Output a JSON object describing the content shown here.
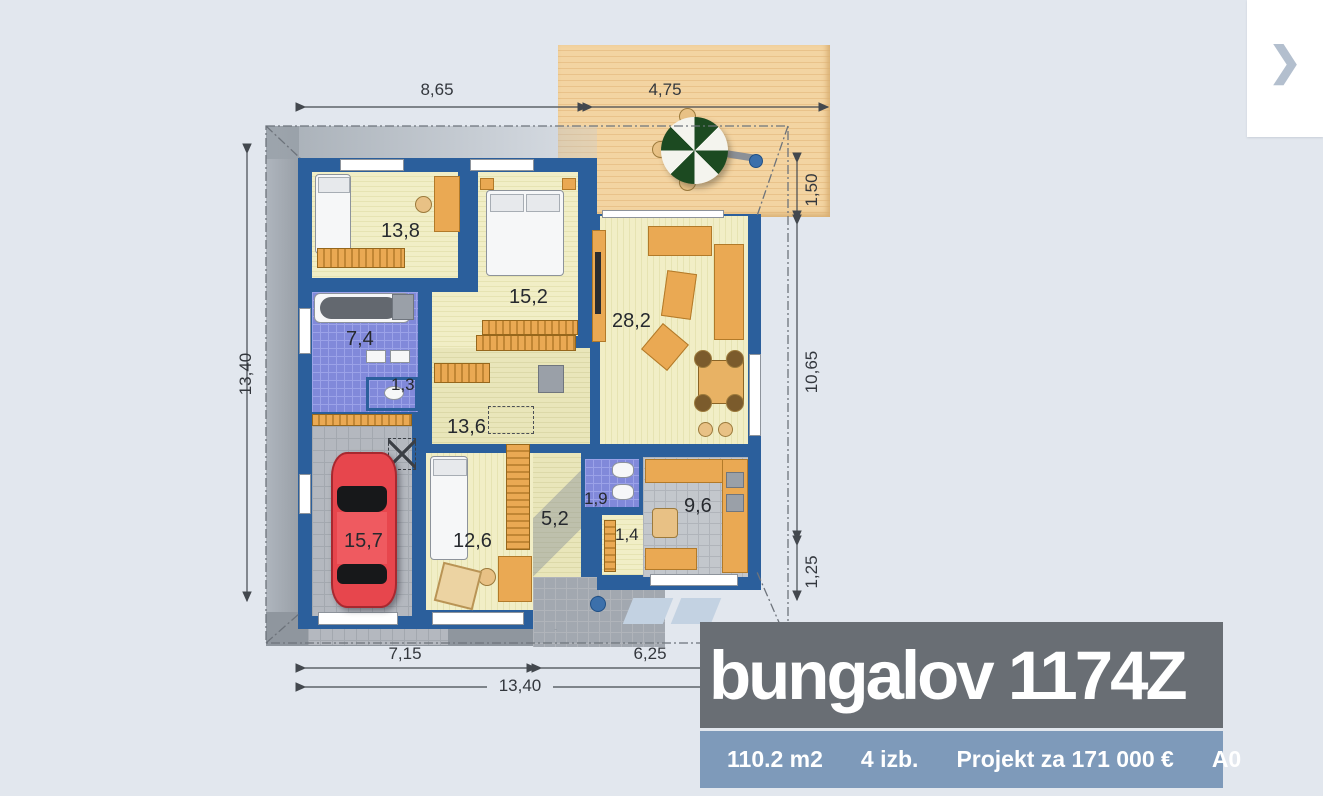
{
  "colors": {
    "page_bg": "#e2e7ee",
    "wall_blue": "#2b5f9c",
    "floor_pale": "#efecc3",
    "tile_blue": "#8189da",
    "deck_wood": "#f1ce9c",
    "car_red": "#e8424a",
    "title_bg": "#696e74",
    "stats_bg": "#7e9aba"
  },
  "gallery": {
    "next_icon": "❯"
  },
  "title_card": {
    "title": "bungalov 1174Z"
  },
  "stats_bar": {
    "items": [
      {
        "label": "110.2 m2"
      },
      {
        "label": "4 izb."
      },
      {
        "label": "Projekt za 171 000 €"
      },
      {
        "label": "A0"
      }
    ]
  },
  "plan": {
    "dimensions": {
      "top": [
        {
          "label": "8,65"
        },
        {
          "label": "4,75"
        }
      ],
      "left": [
        {
          "label": "13,40"
        }
      ],
      "right": [
        {
          "label": "1,50"
        },
        {
          "label": "10,65"
        },
        {
          "label": "1,25"
        }
      ],
      "bottom": [
        {
          "label": "7,15"
        },
        {
          "label": "6,25"
        },
        {
          "label": "13,40"
        }
      ]
    },
    "rooms": [
      {
        "name": "bedroom-1",
        "area": "13,8"
      },
      {
        "name": "bedroom-2",
        "area": "15,2"
      },
      {
        "name": "living-room",
        "area": "28,2"
      },
      {
        "name": "bathroom",
        "area": "7,4"
      },
      {
        "name": "wc",
        "area": "1,3"
      },
      {
        "name": "hall",
        "area": "13,6"
      },
      {
        "name": "garage",
        "area": "15,7"
      },
      {
        "name": "bedroom-3",
        "area": "12,6"
      },
      {
        "name": "corridor",
        "area": "5,2"
      },
      {
        "name": "wc-2",
        "area": "1,9"
      },
      {
        "name": "pantry",
        "area": "1,4"
      },
      {
        "name": "kitchen",
        "area": "9,6"
      }
    ]
  }
}
